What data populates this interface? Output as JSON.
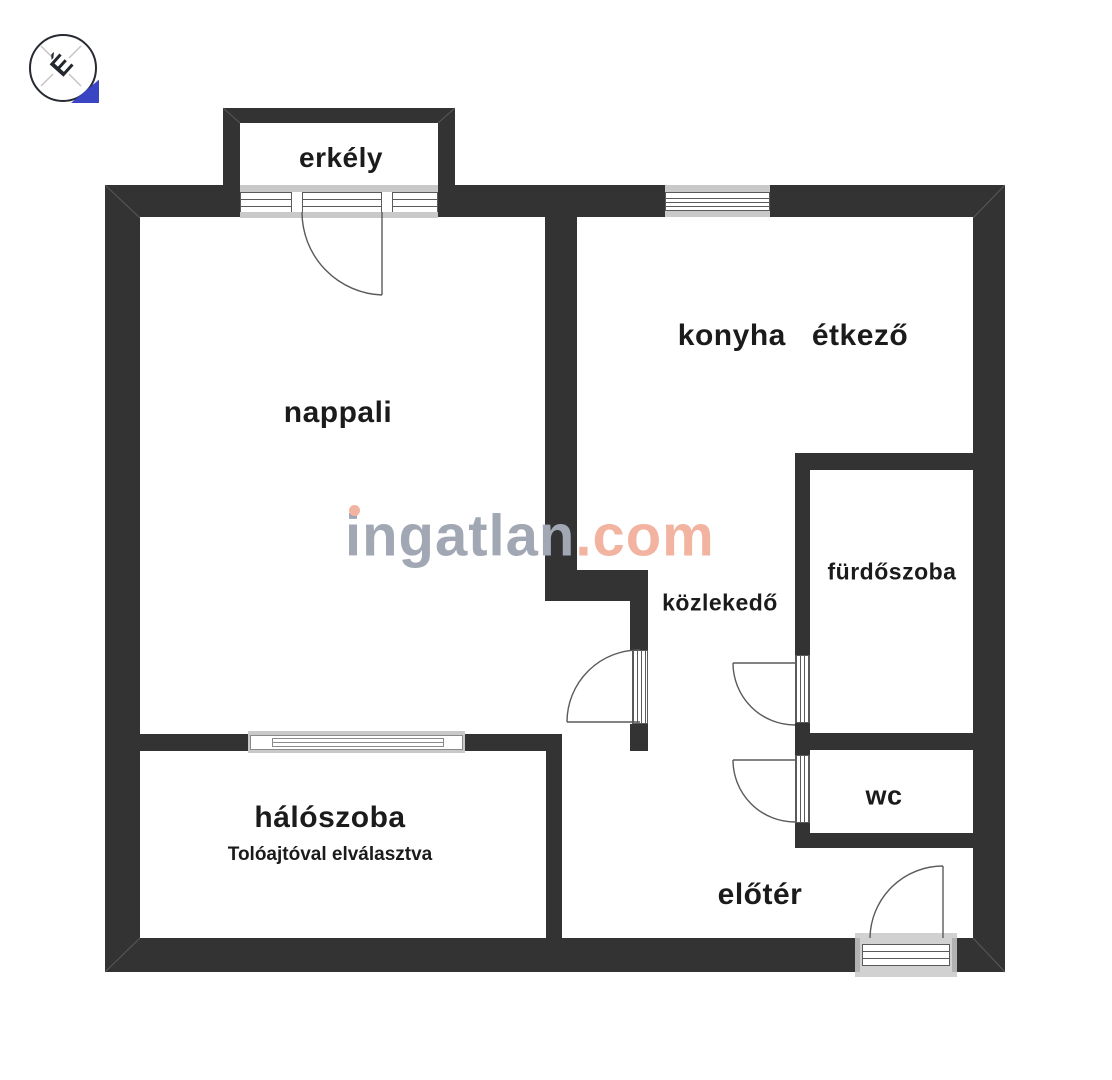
{
  "brand": {
    "watermark_name": "ingatlan",
    "watermark_tld": ".com"
  },
  "north_indicator": {
    "letter": "É"
  },
  "rooms": {
    "balcony": "erkély",
    "living_room": "nappali",
    "kitchen": "konyha",
    "dining": "étkező",
    "hallway": "közlekedő",
    "bathroom": "fürdőszoba",
    "wc": "wc",
    "bedroom": "hálószoba",
    "bedroom_note": "Tolóajtóval elválasztva",
    "foyer": "előtér"
  },
  "colors": {
    "wall": "#333333",
    "sill": "#c9c9c9",
    "line": "#5a5a5a",
    "ink": "#1b1b1b",
    "wm-gray": "#a2a7b4",
    "wm-salmon": "#f2b3a0",
    "blue": "#3a45c4"
  }
}
